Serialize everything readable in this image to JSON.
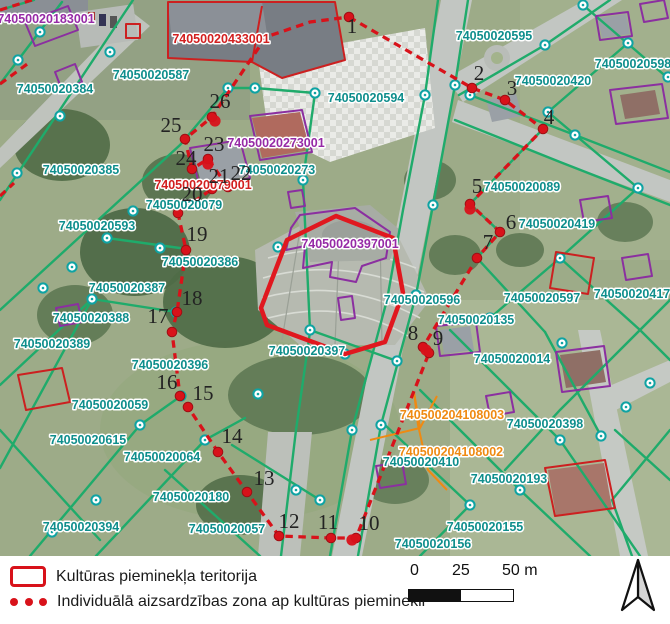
{
  "legend": {
    "items": [
      {
        "symbol": "monument-area-rect",
        "label": "Kultūras pieminekļa teritorija"
      },
      {
        "symbol": "protection-zone-dots",
        "label": "Individuālā aizsardzības zona ap kultūras pieminekli"
      }
    ]
  },
  "scale_bar": {
    "ticks": [
      "0",
      "25",
      "50 m"
    ]
  },
  "map": {
    "colors": {
      "parcel_line": "#1fab6b",
      "parcel_label": "#0e8e8c",
      "building_label_purple": "#962aa6",
      "building_label_red": "#d21f1f",
      "engineering_label_orange": "#ef8a12",
      "monument_area_outline": "#e0181f",
      "protection_zone_line": "#d8121a"
    },
    "labels": [
      {
        "text": "74050020183001",
        "x": 46,
        "y": 23,
        "color": "purple"
      },
      {
        "text": "74050020433001",
        "x": 221,
        "y": 43,
        "color": "red"
      },
      {
        "text": "74050020587",
        "x": 151,
        "y": 79,
        "color": "teal"
      },
      {
        "text": "74050020384",
        "x": 55,
        "y": 93,
        "color": "teal"
      },
      {
        "text": "74050020594",
        "x": 366,
        "y": 102,
        "color": "teal"
      },
      {
        "text": "74050020595",
        "x": 494,
        "y": 40,
        "color": "teal"
      },
      {
        "text": "74050020420",
        "x": 553,
        "y": 85,
        "color": "teal"
      },
      {
        "text": "74050020598",
        "x": 633,
        "y": 68,
        "color": "teal"
      },
      {
        "text": "74050020273001",
        "x": 276,
        "y": 147,
        "color": "purple"
      },
      {
        "text": "74050020273",
        "x": 277,
        "y": 174,
        "color": "teal"
      },
      {
        "text": "74050020385",
        "x": 81,
        "y": 174,
        "color": "teal"
      },
      {
        "text": "74050020079001",
        "x": 203,
        "y": 189,
        "color": "red"
      },
      {
        "text": "74050020079",
        "x": 184,
        "y": 209,
        "color": "teal"
      },
      {
        "text": "74050020593",
        "x": 97,
        "y": 230,
        "color": "teal"
      },
      {
        "text": "74050020089",
        "x": 522,
        "y": 191,
        "color": "teal"
      },
      {
        "text": "74050020397001",
        "x": 350,
        "y": 248,
        "color": "purple"
      },
      {
        "text": "74050020386",
        "x": 200,
        "y": 266,
        "color": "teal"
      },
      {
        "text": "74050020419",
        "x": 557,
        "y": 228,
        "color": "teal"
      },
      {
        "text": "74050020387",
        "x": 127,
        "y": 292,
        "color": "teal"
      },
      {
        "text": "74050020596",
        "x": 422,
        "y": 304,
        "color": "teal"
      },
      {
        "text": "74050020597",
        "x": 542,
        "y": 302,
        "color": "teal"
      },
      {
        "text": "74050020417",
        "x": 632,
        "y": 298,
        "color": "teal"
      },
      {
        "text": "74050020388",
        "x": 91,
        "y": 322,
        "color": "teal"
      },
      {
        "text": "74050020135",
        "x": 476,
        "y": 324,
        "color": "teal"
      },
      {
        "text": "74050020389",
        "x": 52,
        "y": 348,
        "color": "teal"
      },
      {
        "text": "74050020397",
        "x": 307,
        "y": 355,
        "color": "teal"
      },
      {
        "text": "74050020014",
        "x": 512,
        "y": 363,
        "color": "teal"
      },
      {
        "text": "74050020396",
        "x": 170,
        "y": 369,
        "color": "teal"
      },
      {
        "text": "74050020059",
        "x": 110,
        "y": 409,
        "color": "teal"
      },
      {
        "text": "740500204108003",
        "x": 452,
        "y": 419,
        "color": "orange"
      },
      {
        "text": "74050020398",
        "x": 545,
        "y": 428,
        "color": "teal"
      },
      {
        "text": "74050020615",
        "x": 88,
        "y": 444,
        "color": "teal"
      },
      {
        "text": "740500204108002",
        "x": 451,
        "y": 456,
        "color": "orange"
      },
      {
        "text": "74050020064",
        "x": 162,
        "y": 461,
        "color": "teal"
      },
      {
        "text": "74050020410",
        "x": 421,
        "y": 466,
        "color": "teal"
      },
      {
        "text": "74050020193",
        "x": 509,
        "y": 483,
        "color": "teal"
      },
      {
        "text": "74050020180",
        "x": 191,
        "y": 501,
        "color": "teal"
      },
      {
        "text": "74050020394",
        "x": 81,
        "y": 531,
        "color": "teal"
      },
      {
        "text": "74050020057",
        "x": 227,
        "y": 533,
        "color": "teal"
      },
      {
        "text": "74050020155",
        "x": 485,
        "y": 531,
        "color": "teal"
      },
      {
        "text": "74050020156",
        "x": 433,
        "y": 548,
        "color": "teal"
      }
    ],
    "zone_vertices": [
      {
        "n": "1",
        "nx": 352,
        "ny": 33,
        "dx": 349,
        "dy": 17
      },
      {
        "n": "2",
        "nx": 479,
        "ny": 80,
        "dx": 472,
        "dy": 88
      },
      {
        "n": "3",
        "nx": 512,
        "ny": 95,
        "dx": 505,
        "dy": 100
      },
      {
        "n": "4",
        "nx": 549,
        "ny": 124,
        "dx": 543,
        "dy": 129
      },
      {
        "n": "5",
        "nx": 477,
        "ny": 193,
        "dx": 470,
        "dy": 204
      },
      {
        "n": "6",
        "nx": 511,
        "ny": 229,
        "dx": 500,
        "dy": 232
      },
      {
        "n": "7",
        "nx": 488,
        "ny": 249,
        "dx": 477,
        "dy": 258
      },
      {
        "n": "8",
        "nx": 413,
        "ny": 340,
        "dx": 423,
        "dy": 347
      },
      {
        "n": "9",
        "nx": 438,
        "ny": 345,
        "dx": 429,
        "dy": 353
      },
      {
        "n": "10",
        "nx": 369,
        "ny": 530,
        "dx": 356,
        "dy": 538
      },
      {
        "n": "11",
        "nx": 328,
        "ny": 529,
        "dx": 331,
        "dy": 538
      },
      {
        "n": "12",
        "nx": 289,
        "ny": 528,
        "dx": 279,
        "dy": 536
      },
      {
        "n": "13",
        "nx": 264,
        "ny": 485,
        "dx": 247,
        "dy": 492
      },
      {
        "n": "14",
        "nx": 232,
        "ny": 443,
        "dx": 218,
        "dy": 452
      },
      {
        "n": "15",
        "nx": 203,
        "ny": 400,
        "dx": 188,
        "dy": 407
      },
      {
        "n": "16",
        "nx": 167,
        "ny": 389,
        "dx": 180,
        "dy": 396
      },
      {
        "n": "17",
        "nx": 158,
        "ny": 323,
        "dx": 172,
        "dy": 332
      },
      {
        "n": "18",
        "nx": 192,
        "ny": 305,
        "dx": 177,
        "dy": 312
      },
      {
        "n": "19",
        "nx": 197,
        "ny": 241,
        "dx": 186,
        "dy": 250
      },
      {
        "n": "20",
        "nx": 192,
        "ny": 201,
        "dx": 178,
        "dy": 213
      },
      {
        "n": "21",
        "nx": 219,
        "ny": 183,
        "dx": 212,
        "dy": 189
      },
      {
        "n": "22",
        "nx": 241,
        "ny": 180,
        "dx": 228,
        "dy": 187
      },
      {
        "n": "23",
        "nx": 214,
        "ny": 151,
        "dx": 208,
        "dy": 159
      },
      {
        "n": "24",
        "nx": 186,
        "ny": 165,
        "dx": 192,
        "dy": 169
      },
      {
        "n": "25",
        "nx": 171,
        "ny": 132,
        "dx": 185,
        "dy": 139
      },
      {
        "n": "26",
        "nx": 220,
        "ny": 108,
        "dx": 212,
        "dy": 117
      }
    ]
  }
}
